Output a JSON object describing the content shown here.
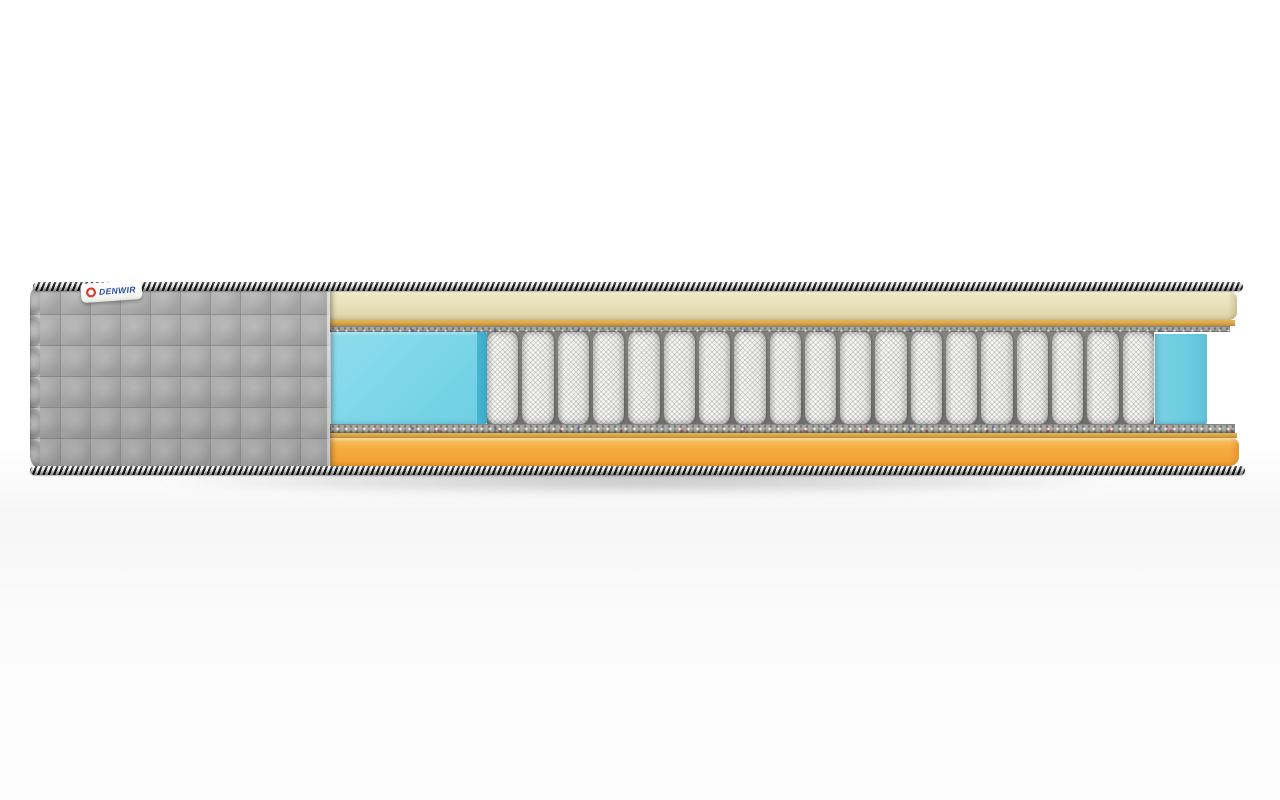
{
  "product": {
    "name": "mattress-cutaway-render",
    "description": "Cross-section product render of a pocket-spring mattress on a white studio background"
  },
  "label": {
    "brand": "DENWIR"
  },
  "springs": {
    "count": 19
  },
  "layers": [
    {
      "name": "braided-edge-cord",
      "color": "#1a1a1a"
    },
    {
      "name": "quilted-cover",
      "color": "#a8a8a8"
    },
    {
      "name": "top-comfort-foam",
      "color": "#eae3bc"
    },
    {
      "name": "adhesive-foam-strip",
      "color": "#d9a84a"
    },
    {
      "name": "felt-pad",
      "color": "#aaa8a3"
    },
    {
      "name": "memory-foam-block",
      "color": "#7ed7e9"
    },
    {
      "name": "pocket-spring-unit",
      "color": "#f6f6f4"
    },
    {
      "name": "base-foam",
      "color": "#f6ab3f"
    }
  ],
  "colors": {
    "cover_gray": "#a8a8a8",
    "cord_dark": "#1a1a1a",
    "cord_light": "#efefef",
    "top_foam_cream": "#eae3bc",
    "top_foam_cream_deep": "#ddd3a6",
    "mustard": "#d9a84a",
    "mustard_deep": "#bb8a30",
    "felt_gray": "#aaa8a3",
    "felt_gray_deep": "#96948f",
    "foam_cyan": "#7ed7e9",
    "foam_cyan_face": "#45b6d2",
    "foam_cyan_end": "#6fcde2",
    "spring_white": "#f6f6f4",
    "spring_edge": "#c9c9c7",
    "base_orange": "#f6ab3f",
    "base_orange_face": "#df912c",
    "label_blue": "#2b4ea2",
    "label_red": "#d93a2e"
  }
}
